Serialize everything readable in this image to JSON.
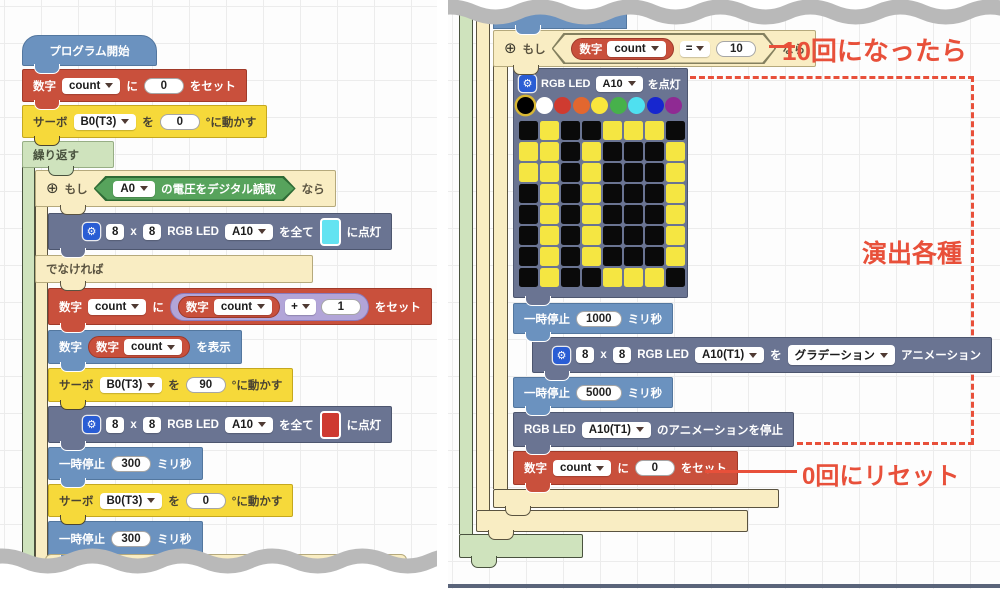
{
  "annotations": {
    "when_10": "10回になったら",
    "effects": "演出各種",
    "reset": "0回にリセット",
    "color": "#e8503a"
  },
  "icons": {
    "gear": "⚙",
    "expand": "⊕",
    "dropdown_arrow": "down-triangle"
  },
  "led": {
    "palette": [
      "#000000",
      "#ffffff",
      "#cf3b30",
      "#e2672f",
      "#f9e63d",
      "#47b14b",
      "#4fe0f0",
      "#1726cf",
      "#8f2a93"
    ],
    "selected": 0,
    "on_color": "#f5e642",
    "off_color": "#0a0a0a",
    "grid": [
      "01001110",
      "11010001",
      "11010001",
      "01010001",
      "01010001",
      "01010001",
      "01010001",
      "01001110"
    ]
  },
  "left_walls": [
    {
      "name": "repeat-wall",
      "color": "green",
      "x": 22,
      "y": 167,
      "w": 13,
      "h": 405
    },
    {
      "name": "if-wall",
      "color": "tan",
      "x": 35,
      "y": 206,
      "w": 13,
      "h": 366
    }
  ],
  "right_walls": [
    {
      "name": "repeat-wall",
      "color": "green",
      "x": 459,
      "y": 4,
      "w": 14,
      "h": 530
    },
    {
      "name": "outer-if-wall",
      "color": "tan",
      "x": 476,
      "y": 10,
      "w": 14,
      "h": 500
    },
    {
      "name": "if-count-10-wall",
      "color": "tan",
      "x": 493,
      "y": 64,
      "w": 15,
      "h": 425
    }
  ],
  "left_blocks": [
    {
      "name": "program-start",
      "kind": "hat",
      "color": "blue",
      "x": 22,
      "y": 35,
      "h": 31,
      "minw": 135,
      "bump": 12,
      "segs": [
        {
          "t": "txt",
          "v": "プログラム開始"
        }
      ]
    },
    {
      "name": "set-count-0",
      "kind": "stmt",
      "color": "red",
      "x": 22,
      "y": 69,
      "h": 33,
      "bump": 12,
      "segs": [
        {
          "t": "txt",
          "v": "数字"
        },
        {
          "t": "dd",
          "v": "count"
        },
        {
          "t": "txt",
          "v": "に"
        },
        {
          "t": "oval",
          "v": "0"
        },
        {
          "t": "txt",
          "v": "をセット"
        }
      ]
    },
    {
      "name": "servo-move-0",
      "kind": "stmt",
      "color": "yellow",
      "x": 22,
      "y": 105,
      "h": 33,
      "bump": 12,
      "segs": [
        {
          "t": "txt",
          "v": "サーボ"
        },
        {
          "t": "dd",
          "v": "B0(T3)"
        },
        {
          "t": "txt",
          "v": "を"
        },
        {
          "t": "oval",
          "v": "0"
        },
        {
          "t": "txt",
          "v": "°に動かす"
        }
      ]
    },
    {
      "name": "repeat-header",
      "kind": "chead",
      "color": "green",
      "x": 22,
      "y": 141,
      "h": 27,
      "minw": 92,
      "bump": 26,
      "segs": [
        {
          "t": "txt",
          "v": "繰り返す"
        }
      ]
    },
    {
      "name": "if-header",
      "kind": "chead",
      "color": "tan",
      "x": 35,
      "y": 170,
      "h": 37,
      "minw": 278,
      "bump": 25,
      "segs": [
        {
          "t": "plus"
        },
        {
          "t": "txt",
          "v": "もし"
        },
        {
          "t": "hex",
          "bg": "green",
          "segs": [
            {
              "t": "dd",
              "v": "A0"
            },
            {
              "t": "txt",
              "v": "の電圧をデジタル読取"
            }
          ]
        },
        {
          "t": "txt",
          "v": "なら"
        }
      ]
    },
    {
      "name": "led-all-on-cyan",
      "kind": "stmt",
      "color": "slate",
      "x": 48,
      "y": 213,
      "h": 37,
      "padL": 34,
      "bump": 12,
      "segs": [
        {
          "t": "gear"
        },
        {
          "t": "sq",
          "v": "8"
        },
        {
          "t": "txt",
          "v": "x"
        },
        {
          "t": "sq",
          "v": "8"
        },
        {
          "t": "txt",
          "v": "RGB LED"
        },
        {
          "t": "dd",
          "v": "A10"
        },
        {
          "t": "txt",
          "v": "を全て"
        },
        {
          "t": "swatch",
          "v": "#63e3f1"
        },
        {
          "t": "txt",
          "v": "に点灯"
        }
      ]
    },
    {
      "name": "else-bar",
      "kind": "cbar",
      "color": "tan",
      "x": 35,
      "y": 255,
      "h": 28,
      "minw": 278,
      "bump": 25,
      "segs": [
        {
          "t": "txt",
          "v": "でなければ"
        }
      ]
    },
    {
      "name": "set-count-plus-1",
      "kind": "stmt",
      "color": "red",
      "x": 48,
      "y": 288,
      "h": 37,
      "bump": 12,
      "segs": [
        {
          "t": "txt",
          "v": "数字"
        },
        {
          "t": "dd",
          "v": "count"
        },
        {
          "t": "txt",
          "v": "に"
        },
        {
          "t": "cap",
          "bg": "purple",
          "segs": [
            {
              "t": "cap",
              "bg": "red",
              "segs": [
                {
                  "t": "txt",
                  "v": "数字"
                },
                {
                  "t": "dd",
                  "v": "count"
                }
              ]
            },
            {
              "t": "ddsq",
              "v": "+"
            },
            {
              "t": "oval",
              "v": "1"
            }
          ]
        },
        {
          "t": "txt",
          "v": "をセット"
        }
      ]
    },
    {
      "name": "display-count",
      "kind": "stmt",
      "color": "blue",
      "x": 48,
      "y": 330,
      "h": 34,
      "bump": 12,
      "segs": [
        {
          "t": "txt",
          "v": "数字"
        },
        {
          "t": "cap",
          "bg": "red",
          "segs": [
            {
              "t": "txt",
              "v": "数字"
            },
            {
              "t": "dd",
              "v": "count"
            }
          ]
        },
        {
          "t": "txt",
          "v": "を表示"
        }
      ]
    },
    {
      "name": "servo-move-90",
      "kind": "stmt",
      "color": "yellow",
      "x": 48,
      "y": 368,
      "h": 34,
      "bump": 12,
      "segs": [
        {
          "t": "txt",
          "v": "サーボ"
        },
        {
          "t": "dd",
          "v": "B0(T3)"
        },
        {
          "t": "txt",
          "v": "を"
        },
        {
          "t": "oval",
          "v": "90"
        },
        {
          "t": "txt",
          "v": "°に動かす"
        }
      ]
    },
    {
      "name": "led-all-on-red",
      "kind": "stmt",
      "color": "slate",
      "x": 48,
      "y": 406,
      "h": 37,
      "padL": 34,
      "bump": 12,
      "segs": [
        {
          "t": "gear"
        },
        {
          "t": "sq",
          "v": "8"
        },
        {
          "t": "txt",
          "v": "x"
        },
        {
          "t": "sq",
          "v": "8"
        },
        {
          "t": "txt",
          "v": "RGB LED"
        },
        {
          "t": "dd",
          "v": "A10"
        },
        {
          "t": "txt",
          "v": "を全て"
        },
        {
          "t": "swatch",
          "v": "#ce3a31"
        },
        {
          "t": "txt",
          "v": "に点灯"
        }
      ]
    },
    {
      "name": "pause-300-a",
      "kind": "stmt",
      "color": "blue",
      "x": 48,
      "y": 447,
      "h": 33,
      "bump": 12,
      "segs": [
        {
          "t": "txt",
          "v": "一時停止"
        },
        {
          "t": "oval",
          "v": "300"
        },
        {
          "t": "txt",
          "v": "ミリ秒"
        }
      ]
    },
    {
      "name": "servo-move-0-b",
      "kind": "stmt",
      "color": "yellow",
      "x": 48,
      "y": 484,
      "h": 33,
      "bump": 12,
      "segs": [
        {
          "t": "txt",
          "v": "サーボ"
        },
        {
          "t": "dd",
          "v": "B0(T3)"
        },
        {
          "t": "txt",
          "v": "を"
        },
        {
          "t": "oval",
          "v": "0"
        },
        {
          "t": "txt",
          "v": "°に動かす"
        }
      ]
    },
    {
      "name": "pause-300-b",
      "kind": "stmt",
      "color": "blue",
      "x": 48,
      "y": 521,
      "h": 36,
      "bump": 12,
      "segs": [
        {
          "t": "txt",
          "v": "一時停止"
        },
        {
          "t": "oval",
          "v": "300"
        },
        {
          "t": "txt",
          "v": "ミリ秒"
        }
      ]
    },
    {
      "name": "torn-block-fragment",
      "kind": "frag-tan",
      "x": 45,
      "y": 554,
      "w": 360,
      "h": 30
    }
  ],
  "right_blocks": [
    {
      "name": "torn-block-fragment-blue",
      "kind": "frag-blue",
      "x": 493,
      "y": 5,
      "w": 132,
      "h": 22,
      "bump": 22
    },
    {
      "name": "if-count-10-header",
      "kind": "chead",
      "color": "tan",
      "x": 493,
      "y": 30,
      "h": 37,
      "minw": 278,
      "bump": 20,
      "segs": [
        {
          "t": "plus"
        },
        {
          "t": "txt",
          "v": "もし"
        },
        {
          "t": "hex",
          "bg": "tan",
          "segs": [
            {
              "t": "cap",
              "bg": "red",
              "segs": [
                {
                  "t": "txt",
                  "v": "数字"
                },
                {
                  "t": "dd",
                  "v": "count"
                }
              ]
            },
            {
              "t": "ddsq",
              "v": "="
            },
            {
              "t": "oval",
              "v": "10"
            }
          ]
        },
        {
          "t": "txt",
          "v": "なら"
        }
      ]
    },
    {
      "name": "led-matrix-block",
      "kind": "led",
      "color": "slate",
      "x": 513,
      "y": 68,
      "w": 175,
      "h": 230,
      "bump": 12,
      "segs": [
        {
          "t": "gear"
        },
        {
          "t": "txt",
          "v": "RGB LED"
        },
        {
          "t": "dd",
          "v": "A10"
        },
        {
          "t": "txt",
          "v": "を点灯"
        }
      ]
    },
    {
      "name": "pause-1000",
      "kind": "stmt",
      "color": "blue",
      "x": 513,
      "y": 303,
      "h": 31,
      "bump": 12,
      "segs": [
        {
          "t": "txt",
          "v": "一時停止"
        },
        {
          "t": "oval",
          "v": "1000"
        },
        {
          "t": "txt",
          "v": "ミリ秒"
        }
      ]
    },
    {
      "name": "led-animation",
      "kind": "stmt",
      "color": "slate",
      "x": 532,
      "y": 337,
      "h": 36,
      "padL": 20,
      "bump": 12,
      "segs": [
        {
          "t": "gear"
        },
        {
          "t": "sq",
          "v": "8"
        },
        {
          "t": "txt",
          "v": "x"
        },
        {
          "t": "sq",
          "v": "8"
        },
        {
          "t": "txt",
          "v": "RGB LED"
        },
        {
          "t": "dd",
          "v": "A10(T1)"
        },
        {
          "t": "txt",
          "v": "を"
        },
        {
          "t": "dd",
          "v": "グラデーション"
        },
        {
          "t": "txt",
          "v": "アニメーション"
        }
      ]
    },
    {
      "name": "pause-5000",
      "kind": "stmt",
      "color": "blue",
      "x": 513,
      "y": 377,
      "h": 31,
      "bump": 12,
      "segs": [
        {
          "t": "txt",
          "v": "一時停止"
        },
        {
          "t": "oval",
          "v": "5000"
        },
        {
          "t": "txt",
          "v": "ミリ秒"
        }
      ]
    },
    {
      "name": "stop-animation",
      "kind": "stmt",
      "color": "slate",
      "x": 513,
      "y": 412,
      "h": 35,
      "bump": 12,
      "segs": [
        {
          "t": "txt",
          "v": "RGB LED"
        },
        {
          "t": "dd",
          "v": "A10(T1)"
        },
        {
          "t": "txt",
          "v": "のアニメーションを停止"
        }
      ]
    },
    {
      "name": "reset-count-0",
      "kind": "stmt",
      "color": "red",
      "x": 513,
      "y": 451,
      "h": 34,
      "bump": 12,
      "segs": [
        {
          "t": "txt",
          "v": "数字"
        },
        {
          "t": "dd",
          "v": "count"
        },
        {
          "t": "txt",
          "v": "に"
        },
        {
          "t": "oval",
          "v": "0"
        },
        {
          "t": "txt",
          "v": "をセット"
        }
      ]
    },
    {
      "name": "if-count-10-footer",
      "kind": "cfoot",
      "color": "tan",
      "x": 493,
      "y": 489,
      "w": 286,
      "h": 19,
      "bump": 12
    },
    {
      "name": "outer-if-footer",
      "kind": "cfoot",
      "color": "tan",
      "x": 476,
      "y": 510,
      "w": 272,
      "h": 22,
      "bump": 12
    },
    {
      "name": "repeat-footer",
      "kind": "cfoot",
      "color": "green",
      "x": 459,
      "y": 534,
      "w": 124,
      "h": 24,
      "bump": 12,
      "tab": true
    }
  ]
}
